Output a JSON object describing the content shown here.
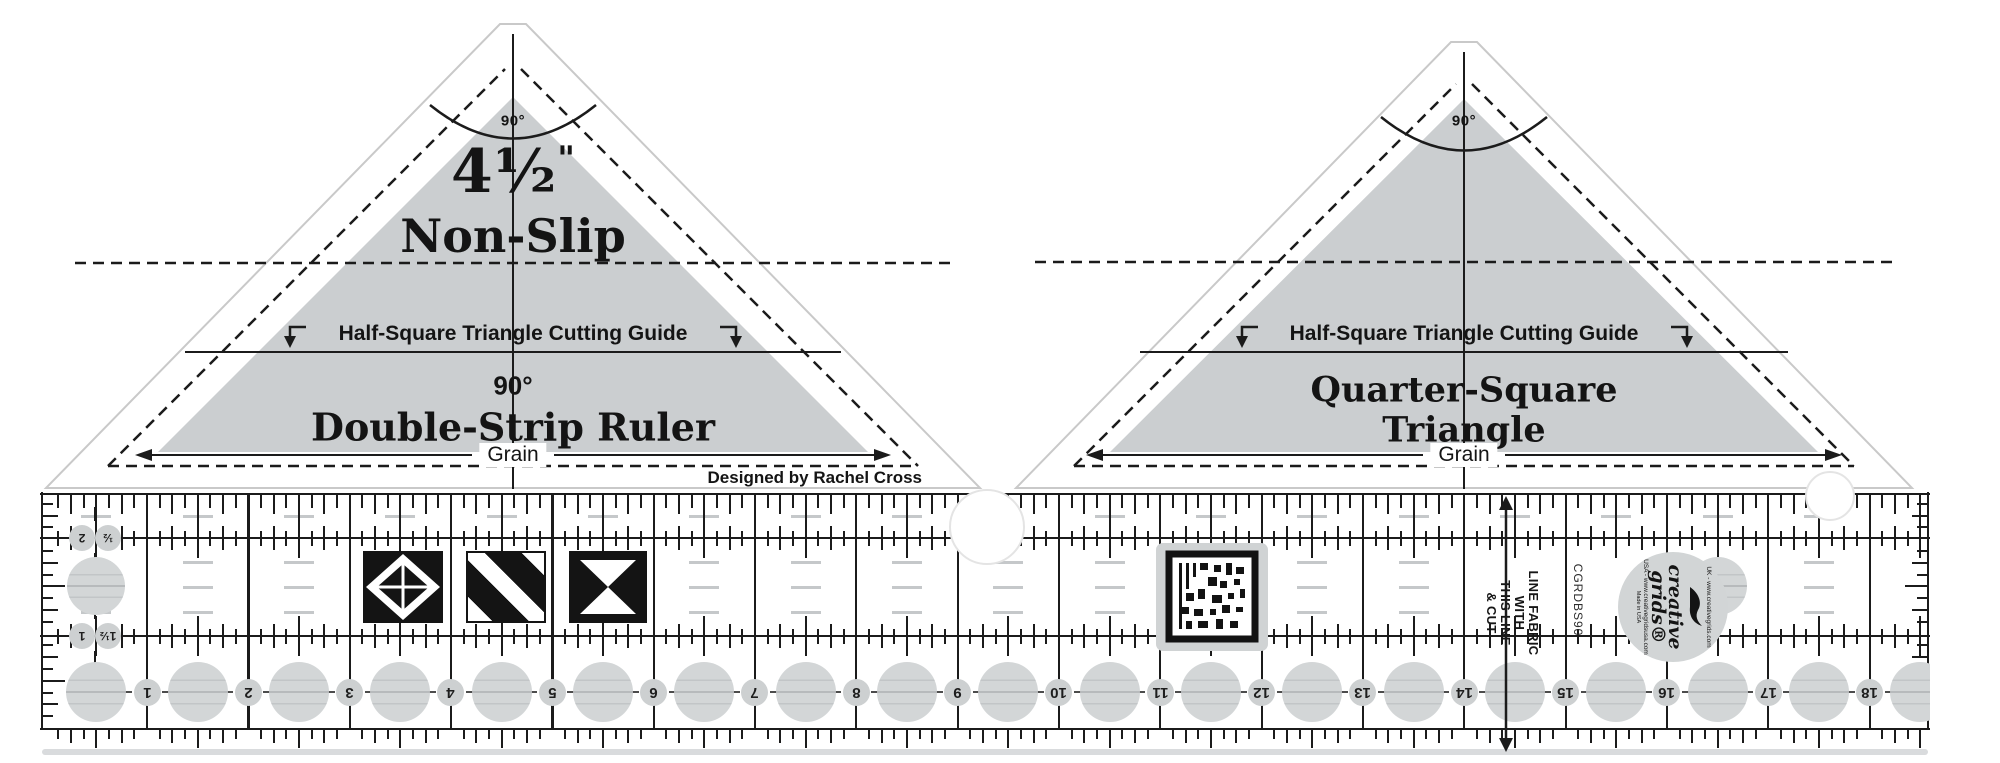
{
  "product_kind": "quilting ruler product photo",
  "left_triangle": {
    "apex_angle_label": "90°",
    "size_value": "4½",
    "size_unit": "\"",
    "nonslip_label": "Non-Slip",
    "cutting_guide_label": "Half-Square Triangle Cutting Guide",
    "angle_label": "90°",
    "title": "Double-Strip Ruler",
    "grain_label": "Grain",
    "credit": "Designed by Rachel Cross"
  },
  "right_triangle": {
    "apex_angle_label": "90°",
    "cutting_guide_label": "Half-Square Triangle Cutting Guide",
    "title_line1": "Quarter-Square",
    "title_line2": "Triangle",
    "grain_label": "Grain"
  },
  "ruler": {
    "inch_numbers": [
      "1",
      "2",
      "3",
      "4",
      "5",
      "6",
      "7",
      "8",
      "9",
      "10",
      "11",
      "12",
      "13",
      "14",
      "15",
      "16",
      "17",
      "18"
    ],
    "side_scale_top": [
      "2",
      "½"
    ],
    "side_scale_bottom": [
      "1",
      "1½"
    ],
    "note_lines": [
      "LINE FABRIC",
      "WITH",
      "THIS LINE",
      "& CUT"
    ],
    "sku": "CGRDBS90",
    "logo": {
      "brand_line1": "creative",
      "brand_line2": "grids®",
      "uk_url": "UK - www.creativegrids.com",
      "usa_url": "USA - www.creativegridsusa.com",
      "made_in": "Made in USA"
    }
  },
  "colors": {
    "print_black": "#1b1b1b",
    "triangle_fill": "#cbced0",
    "dot_fill": "#d3d6d7",
    "faint_dash": "#c5c8ca",
    "logo_fill": "#d2d5d6"
  }
}
